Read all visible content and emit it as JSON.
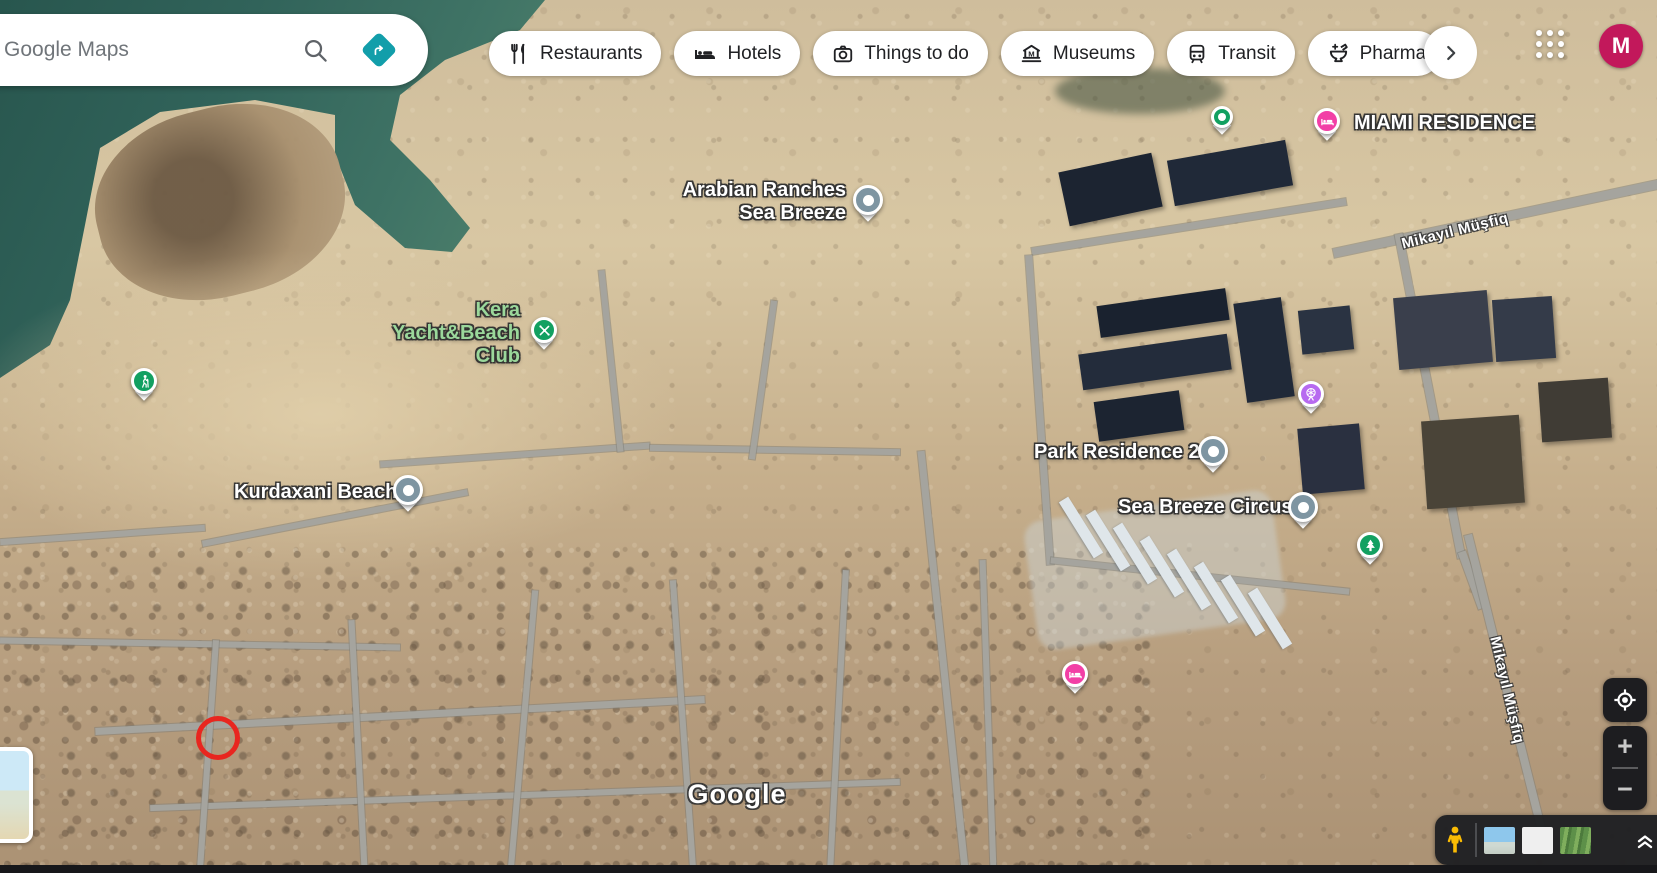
{
  "header": {
    "search": {
      "placeholder": "Google Maps"
    },
    "chips": [
      {
        "label": "Restaurants",
        "icon": "restaurant-icon"
      },
      {
        "label": "Hotels",
        "icon": "hotel-icon"
      },
      {
        "label": "Things to do",
        "icon": "camera-icon"
      },
      {
        "label": "Museums",
        "icon": "museum-icon"
      },
      {
        "label": "Transit",
        "icon": "transit-icon"
      },
      {
        "label": "Pharmacies",
        "icon": "pharmacy-icon",
        "clipped": true
      }
    ],
    "avatar": {
      "letter": "M",
      "color": "#c2185b"
    }
  },
  "map": {
    "place_labels": [
      {
        "lines": [
          "Arabian Ranches",
          "Sea Breeze"
        ],
        "color": "#ffffff",
        "anchor": "right",
        "x": 846,
        "y": 179
      },
      {
        "lines": [
          "Kera",
          "Yacht&Beach",
          "Club"
        ],
        "color": "#9bd89b",
        "anchor": "right",
        "x": 520,
        "y": 299
      },
      {
        "lines": [
          "Kurdaxani Beach"
        ],
        "color": "#ffffff",
        "anchor": "left",
        "x": 234,
        "y": 481
      },
      {
        "lines": [
          "Park Residence 2"
        ],
        "color": "#ffffff",
        "anchor": "left",
        "x": 1034,
        "y": 441
      },
      {
        "lines": [
          "Sea Breeze Circus"
        ],
        "color": "#ffffff",
        "anchor": "left",
        "x": 1118,
        "y": 496
      },
      {
        "lines": [
          "MIAMI RESIDENCE"
        ],
        "color": "#ffffff",
        "anchor": "left",
        "x": 1354,
        "y": 112
      }
    ],
    "street_labels": [
      {
        "text": "Mikayıl Müşfiq",
        "x": 1455,
        "y": 231,
        "rotation": -14
      },
      {
        "text": "Mikayıl Müşfiq",
        "x": 1507,
        "y": 690,
        "rotation": 77
      }
    ],
    "markers": [
      {
        "icon": "place-dot-icon",
        "color": "#7e95a2",
        "x": 868,
        "y": 200,
        "size": "lg"
      },
      {
        "icon": "place-dot-icon",
        "color": "#7e95a2",
        "x": 408,
        "y": 490,
        "size": "lg"
      },
      {
        "icon": "place-dot-icon",
        "color": "#7e95a2",
        "x": 1213,
        "y": 451,
        "size": "lg"
      },
      {
        "icon": "place-dot-icon",
        "color": "#7e95a2",
        "x": 1303,
        "y": 507,
        "size": "lg"
      },
      {
        "icon": "place-dot-icon",
        "color": "#12a061",
        "x": 1222,
        "y": 117,
        "size": "sm"
      },
      {
        "icon": "hotel-bed-icon",
        "color": "#f23fa6",
        "x": 1327,
        "y": 121,
        "size": "md"
      },
      {
        "icon": "hotel-bed-icon",
        "color": "#f23fa6",
        "x": 1075,
        "y": 674,
        "size": "md"
      },
      {
        "icon": "hiker-icon",
        "color": "#12a061",
        "x": 144,
        "y": 381,
        "size": "md"
      },
      {
        "icon": "paddle-icon",
        "color": "#12a061",
        "x": 544,
        "y": 330,
        "size": "md"
      },
      {
        "icon": "tree-icon",
        "color": "#12a061",
        "x": 1370,
        "y": 545,
        "size": "md"
      },
      {
        "icon": "ferris-wheel-icon",
        "color": "#b76af0",
        "x": 1311,
        "y": 394,
        "size": "md"
      }
    ],
    "annotation": {
      "shape": "circle",
      "color": "#e8261f"
    },
    "watermark": "Google"
  },
  "controls": {
    "zoom_in": "+",
    "zoom_out": "−",
    "imagery_thumbnails": [
      "sea",
      "field",
      "vegetation"
    ]
  },
  "colors": {
    "accent_teal": "#129eaa",
    "pin_slate": "#7e95a2",
    "pin_green": "#12a061",
    "pin_pink": "#f23fa6",
    "pin_purple": "#b76af0",
    "avatar": "#c2185b",
    "label_green": "#9bd89b"
  }
}
